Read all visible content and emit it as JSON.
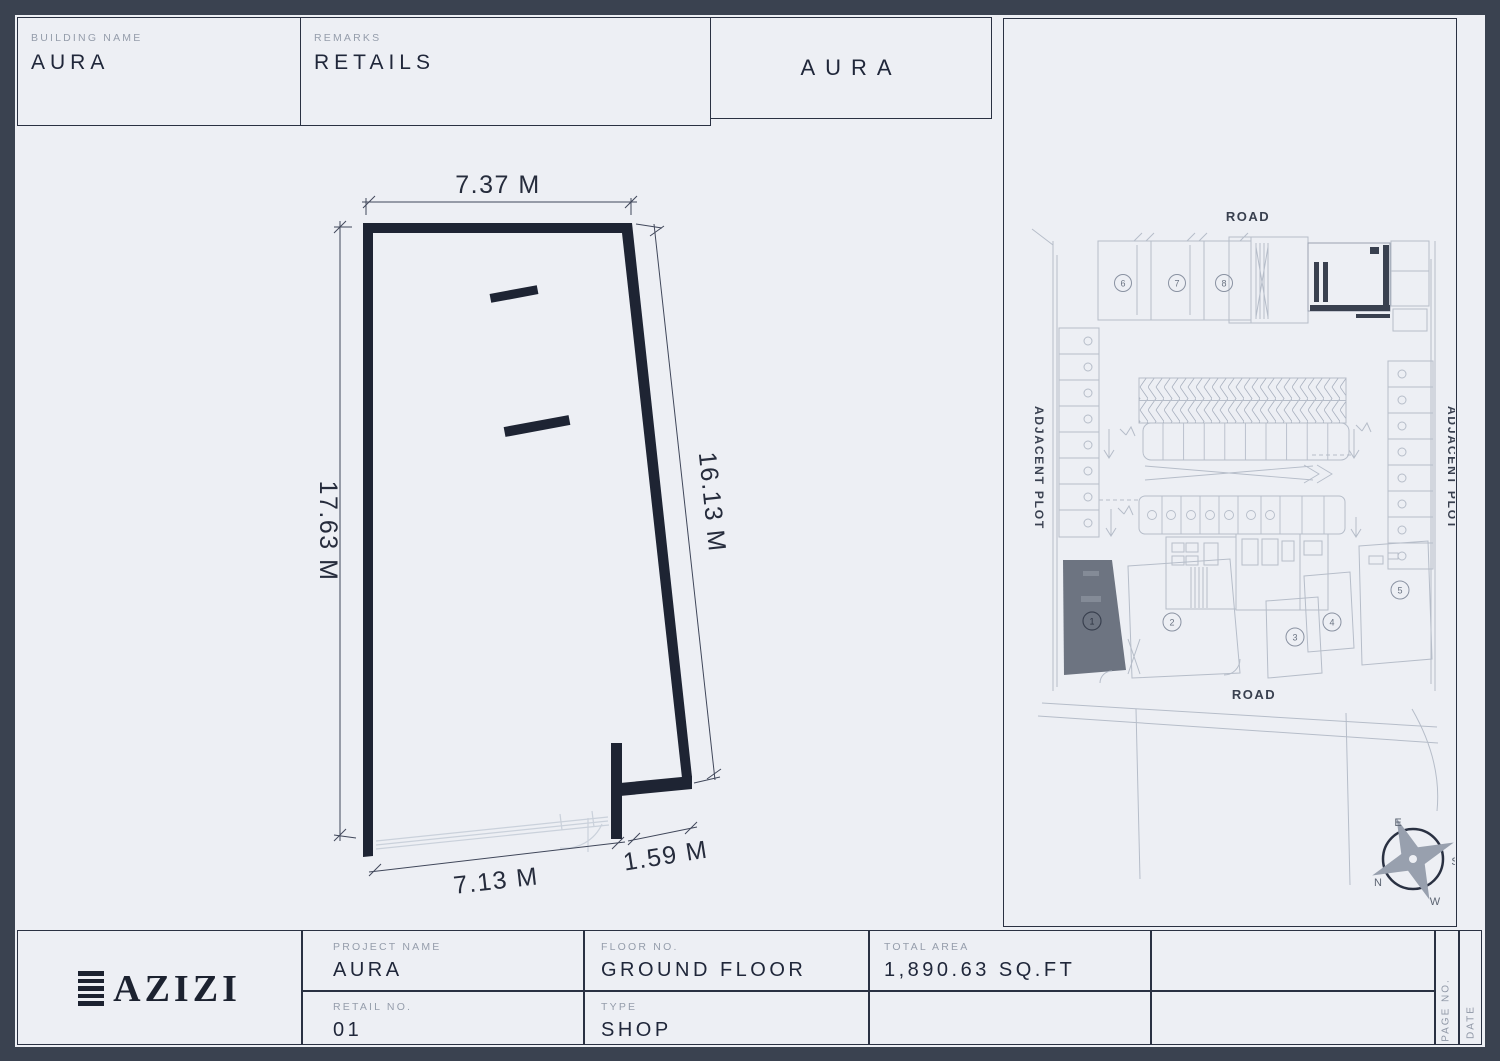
{
  "header": {
    "building_name_label": "BUILDING NAME",
    "building_name": "AURA",
    "remarks_label": "REMARKS",
    "remarks_value": "RETAILS",
    "brand_box": "AURA"
  },
  "plan": {
    "dim_top": "7.37 M",
    "dim_left": "17.63 M",
    "dim_right": "16.13 M",
    "dim_bottom": "7.13 M",
    "dim_bottom_right": "1.59 M"
  },
  "site": {
    "road_top": "ROAD",
    "road_bottom": "ROAD",
    "adjacent_left": "ADJACENT PLOT",
    "adjacent_right": "ADJACENT PLOT",
    "unit_numbers": [
      "1",
      "2",
      "3",
      "4",
      "5",
      "6",
      "7",
      "8"
    ],
    "compass": {
      "e": "E",
      "s": "S",
      "n": "N",
      "w": "W"
    }
  },
  "title_block": {
    "brand": "AZIZI",
    "project_name_label": "PROJECT NAME",
    "project_name": "AURA",
    "floor_label": "FLOOR NO.",
    "floor_value": "GROUND FLOOR",
    "area_label": "TOTAL AREA",
    "area_value": "1,890.63 SQ.FT",
    "retail_label": "RETAIL NO.",
    "retail_value": "01",
    "type_label": "TYPE",
    "type_value": "SHOP",
    "page_label": "PAGE NO.",
    "date_label": "DATE"
  },
  "colors": {
    "ink": "#1e2433",
    "line": "#2a3142",
    "muted": "#959dab",
    "sheet": "#edeff4",
    "frame": "#3a4250",
    "site_line": "#b6bdc9",
    "highlight_fill": "#6d7481"
  }
}
